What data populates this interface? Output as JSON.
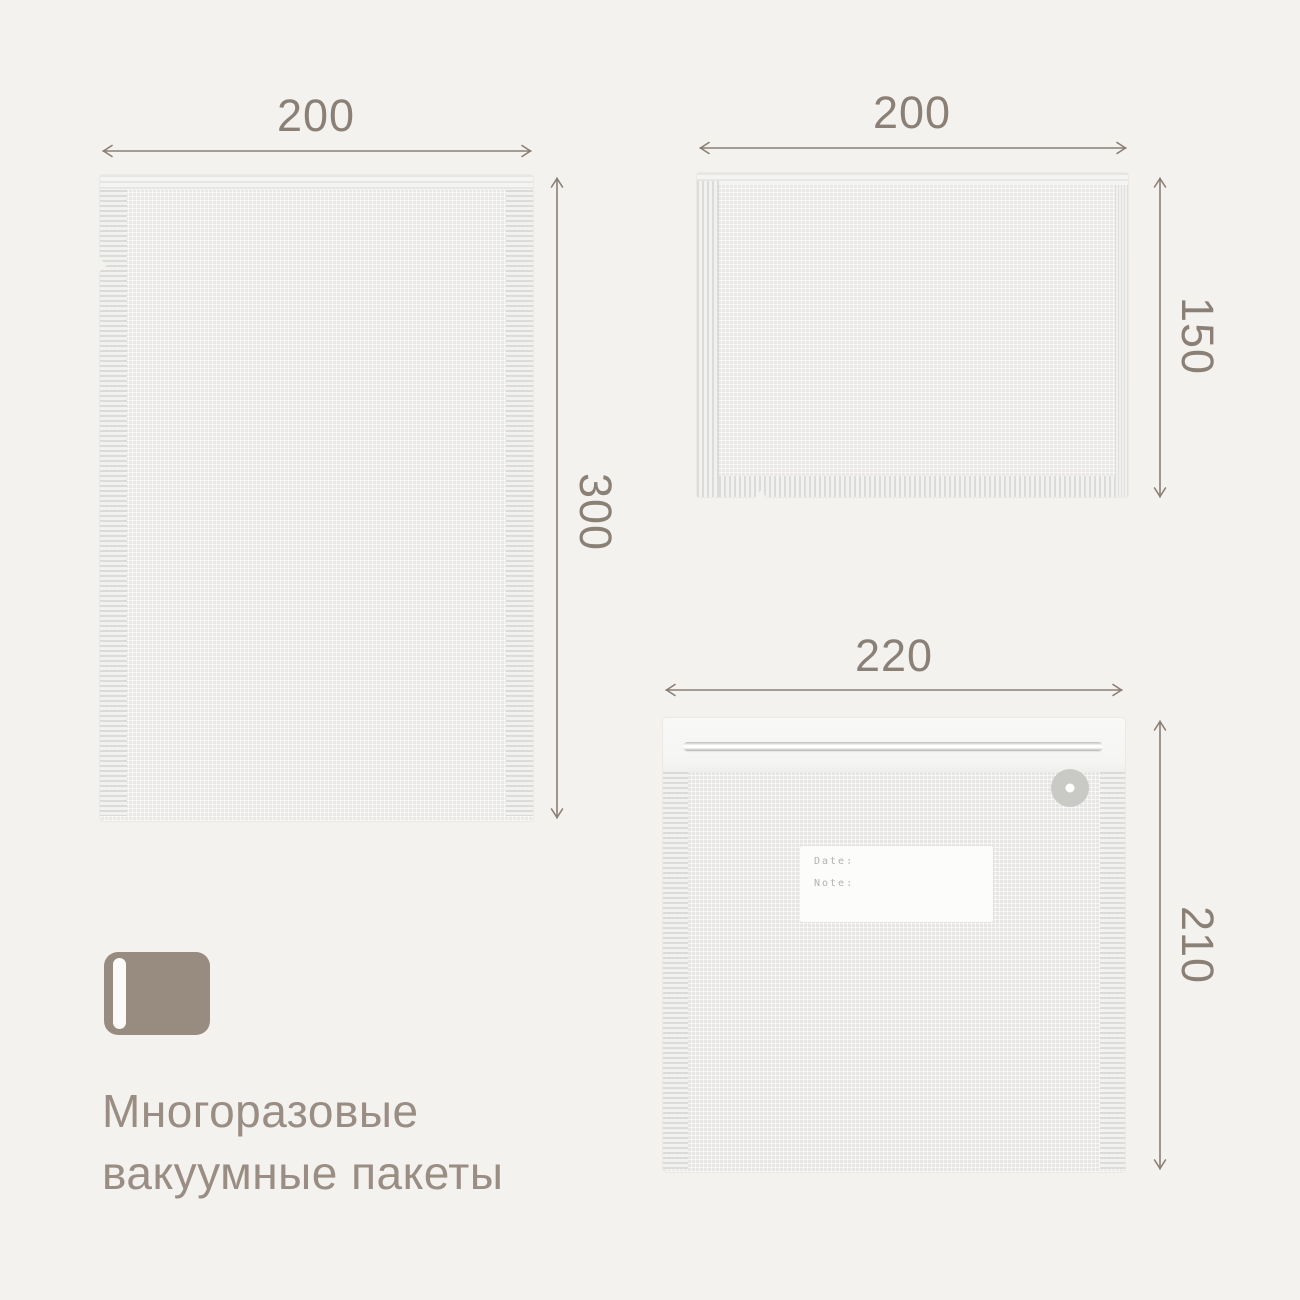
{
  "page": {
    "background_color": "#f4f2ef",
    "accent_color": "#8b8076",
    "arrow_color": "#8a7e74"
  },
  "product": {
    "title_line1": "Многоразовые",
    "title_line2": "вакуумные пакеты",
    "icon": "vacuum-bag-icon",
    "icon_color": "#988b80",
    "title_color": "#9a8d83"
  },
  "bags": [
    {
      "name": "bag-200x300",
      "width_mm": "200",
      "height_mm": "300"
    },
    {
      "name": "bag-200x150",
      "width_mm": "200",
      "height_mm": "150"
    },
    {
      "name": "bag-220x210",
      "width_mm": "220",
      "height_mm": "210",
      "valve": "air-valve",
      "label": {
        "date_field": "Date:",
        "note_field": "Note:"
      }
    }
  ]
}
